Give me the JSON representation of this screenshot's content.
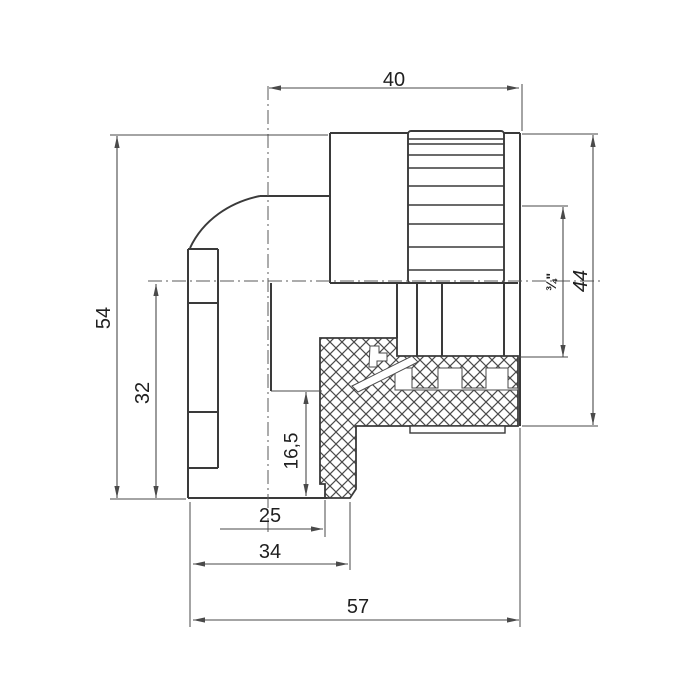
{
  "drawing": {
    "description": "Technical dimension drawing of a 90-degree pipe elbow fitting with knurled female threaded insert, half-section view",
    "canvas": {
      "width": 700,
      "height": 700,
      "background": "#ffffff"
    },
    "colors": {
      "outline": "#3a3a3a",
      "thin": "#4a4a4a",
      "center": "#5a5a5a",
      "hatch": "#4a4a4a",
      "text": "#1f1f1f",
      "white": "#ffffff"
    },
    "body_lines": [
      [
        330,
        133,
        408,
        133
      ],
      [
        504,
        133,
        520,
        133
      ],
      [
        330,
        133,
        330,
        283
      ],
      [
        260,
        196,
        330,
        196
      ],
      [
        188,
        249,
        218,
        249
      ],
      [
        188,
        249,
        188,
        498
      ],
      [
        218,
        249,
        218,
        468
      ],
      [
        188,
        468,
        218,
        468
      ],
      [
        188,
        303,
        218,
        303
      ],
      [
        188,
        412,
        218,
        412
      ],
      [
        188,
        498,
        327,
        498
      ],
      [
        330,
        283,
        518,
        283
      ],
      [
        520,
        133,
        520,
        426
      ],
      [
        397,
        283,
        397,
        338
      ],
      [
        417,
        283,
        417,
        356
      ],
      [
        442,
        283,
        442,
        356
      ],
      [
        504,
        283,
        504,
        356
      ],
      [
        271,
        283,
        271,
        391
      ]
    ],
    "elbow_curve": "M260,196 C230,202 203,220 190,248",
    "knurl": {
      "x": 408,
      "width": 96,
      "top": 131,
      "bottom": 283,
      "groove_ys": [
        139,
        144,
        155,
        168,
        186,
        205,
        224,
        247,
        270
      ]
    },
    "hatch_path": "M320,338 L397,338 L397,356 L518,356 L518,426 L356,426 L356,489 L350,498 L325,498 L325,484 L320,484 Z",
    "white_overlays": [
      {
        "name": "thread-bore-gap",
        "path": "M395,368 L412,368 L412,388 L438,388 L438,368 L462,368 L462,388 L486,388 L486,368 L508,368 L508,388 L518,388 L518,390 L395,390 Z"
      },
      {
        "name": "insert-chamfer-notch",
        "path": "M352,386 L412,356 L418,362 L358,392 Z"
      },
      {
        "name": "thread-start-notch",
        "path": "M370,346 L379,346 L379,353 L387,353 L387,361 L377,361 L377,367 L369,367 Z"
      }
    ],
    "foot": {
      "x": 410,
      "y": 426,
      "width": 95,
      "height": 7
    },
    "centerlines": [
      [
        268,
        86,
        268,
        533
      ],
      [
        148,
        281,
        600,
        281
      ]
    ],
    "extension_lines": [
      [
        522,
        84,
        522,
        131
      ],
      [
        110,
        135,
        328,
        135
      ],
      [
        110,
        499,
        186,
        499
      ],
      [
        271,
        391,
        322,
        391
      ],
      [
        325,
        500,
        325,
        537
      ],
      [
        190,
        502,
        190,
        627
      ],
      [
        350,
        502,
        350,
        570
      ],
      [
        520,
        428,
        520,
        627
      ],
      [
        522,
        206,
        568,
        206
      ],
      [
        518,
        357,
        568,
        357
      ],
      [
        522,
        134,
        598,
        134
      ],
      [
        522,
        426,
        598,
        426
      ]
    ],
    "dimensions": [
      {
        "id": "dim-40",
        "label": "40",
        "line": [
          269,
          88,
          519,
          88
        ],
        "arrows": [
          {
            "x": 269,
            "y": 88,
            "dir": "left"
          },
          {
            "x": 519,
            "y": 88,
            "dir": "right"
          }
        ],
        "label_pos": [
          394,
          80
        ],
        "rotated": false,
        "size": 20,
        "style": "normal"
      },
      {
        "id": "dim-54",
        "label": "54",
        "line": [
          117,
          136,
          117,
          498
        ],
        "arrows": [
          {
            "x": 117,
            "y": 136,
            "dir": "up"
          },
          {
            "x": 117,
            "y": 498,
            "dir": "down"
          }
        ],
        "label_pos": [
          104,
          318
        ],
        "rotated": true,
        "size": 20,
        "style": "normal"
      },
      {
        "id": "dim-32",
        "label": "32",
        "line": [
          156,
          284,
          156,
          498
        ],
        "arrows": [
          {
            "x": 156,
            "y": 284,
            "dir": "up"
          },
          {
            "x": 156,
            "y": 498,
            "dir": "down"
          }
        ],
        "label_pos": [
          143,
          393
        ],
        "rotated": true,
        "size": 20,
        "style": "normal"
      },
      {
        "id": "dim-16-5",
        "label": "16,5",
        "line": [
          306,
          392,
          306,
          496
        ],
        "arrows": [
          {
            "x": 306,
            "y": 392,
            "dir": "up"
          },
          {
            "x": 306,
            "y": 496,
            "dir": "down"
          }
        ],
        "label_pos": [
          292,
          451
        ],
        "rotated": true,
        "size": 19,
        "style": "normal"
      },
      {
        "id": "dim-25",
        "label": "25",
        "line": [
          220,
          529,
          323,
          529
        ],
        "arrows": [
          {
            "x": 323,
            "y": 529,
            "dir": "right"
          }
        ],
        "label_pos": [
          270,
          516
        ],
        "rotated": false,
        "size": 20,
        "style": "normal"
      },
      {
        "id": "dim-34",
        "label": "34",
        "line": [
          193,
          564,
          348,
          564
        ],
        "arrows": [
          {
            "x": 193,
            "y": 564,
            "dir": "left"
          },
          {
            "x": 348,
            "y": 564,
            "dir": "right"
          }
        ],
        "label_pos": [
          270,
          552
        ],
        "rotated": false,
        "size": 20,
        "style": "normal"
      },
      {
        "id": "dim-57",
        "label": "57",
        "line": [
          193,
          620,
          519,
          620
        ],
        "arrows": [
          {
            "x": 193,
            "y": 620,
            "dir": "left"
          },
          {
            "x": 519,
            "y": 620,
            "dir": "right"
          }
        ],
        "label_pos": [
          358,
          607
        ],
        "rotated": false,
        "size": 20,
        "style": "normal"
      },
      {
        "id": "dim-3-4",
        "label": "¾\"",
        "line": [
          563,
          207,
          563,
          357
        ],
        "arrows": [
          {
            "x": 563,
            "y": 207,
            "dir": "up"
          },
          {
            "x": 563,
            "y": 357,
            "dir": "down"
          }
        ],
        "label_pos": [
          551,
          282
        ],
        "rotated": true,
        "size": 14,
        "style": "bold"
      },
      {
        "id": "dim-44",
        "label": "44",
        "line": [
          593,
          135,
          593,
          425
        ],
        "arrows": [
          {
            "x": 593,
            "y": 135,
            "dir": "up"
          },
          {
            "x": 593,
            "y": 425,
            "dir": "down"
          }
        ],
        "label_pos": [
          581,
          281
        ],
        "rotated": true,
        "size": 20,
        "style": "italic"
      }
    ]
  }
}
